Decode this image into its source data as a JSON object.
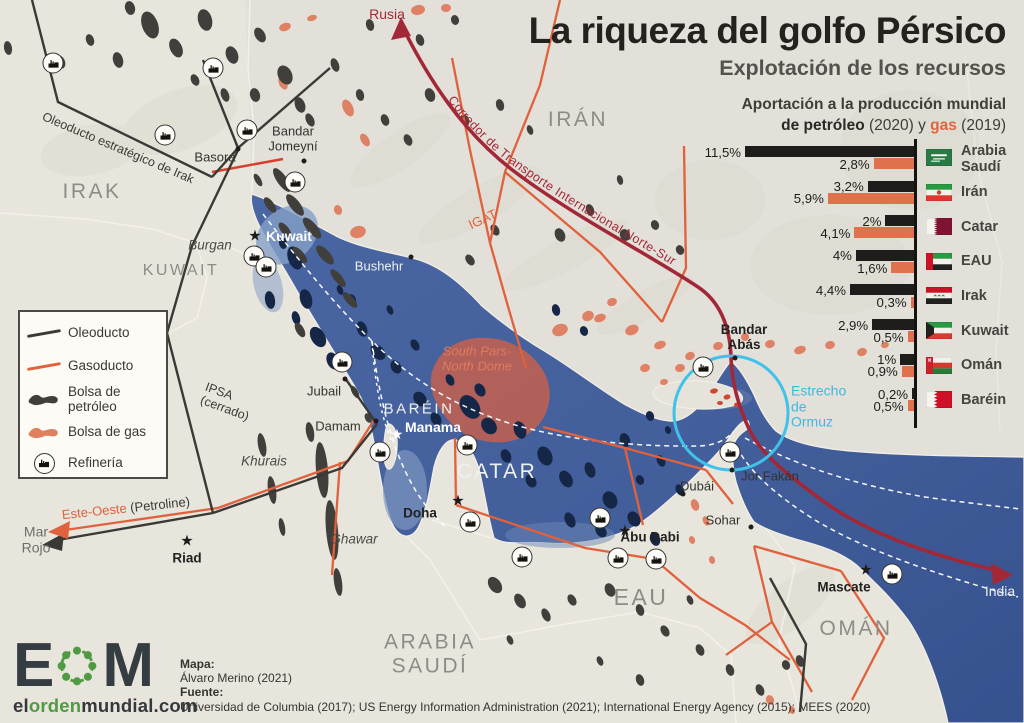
{
  "header": {
    "title": "La riqueza del golfo Pérsico",
    "subtitle": "Explotación de los recursos"
  },
  "chart": {
    "title_line1": "Aportación a la producción mundial",
    "title2_bold": "de petróleo",
    "title2_mid": " (2020) y ",
    "title2_gas": "gas",
    "title2_post": " (2019)",
    "petroleo_color": "#1e1d1b",
    "gas_color": "#e0714d"
  },
  "chart_data": {
    "type": "bar",
    "orientation": "horizontal",
    "title": "Aportación a la producción mundial de petróleo (2020) y gas (2019)",
    "unit": "%",
    "categories": [
      "Arabia Saudí",
      "Irán",
      "Catar",
      "EAU",
      "Irak",
      "Kuwait",
      "Omán",
      "Baréin"
    ],
    "display_names": [
      [
        "Arabia",
        "Saudí"
      ],
      [
        "Irán"
      ],
      [
        "Catar"
      ],
      [
        "EAU"
      ],
      [
        "Irak"
      ],
      [
        "Kuwait"
      ],
      [
        "Omán"
      ],
      [
        "Baréin"
      ]
    ],
    "flags": [
      "sa",
      "ir",
      "qa",
      "ae",
      "iq",
      "kw",
      "om",
      "bh"
    ],
    "series": [
      {
        "name": "petróleo (2020)",
        "color": "#1e1d1b",
        "values": [
          11.5,
          3.2,
          2,
          4,
          4.4,
          2.9,
          1,
          0.2
        ],
        "labels": [
          "11,5%",
          "3,2%",
          "2%",
          "4%",
          "4,4%",
          "2,9%",
          "1%",
          "0,2%"
        ]
      },
      {
        "name": "gas (2019)",
        "color": "#e0714d",
        "values": [
          2.8,
          5.9,
          4.1,
          1.6,
          0.3,
          0.5,
          0.9,
          0.5
        ],
        "labels": [
          "2,8%",
          "5,9%",
          "4,1%",
          "1,6%",
          "0,3%",
          "0,5%",
          "0,9%",
          "0,5%"
        ]
      }
    ],
    "legend_position": "right-flags"
  },
  "legend": {
    "items": [
      {
        "icon": "oil-line",
        "lines": [
          "Oleoducto"
        ]
      },
      {
        "icon": "gas-line",
        "lines": [
          "Gasoducto"
        ]
      },
      {
        "icon": "oil-blob",
        "lines": [
          "Bolsa de",
          "petróleo"
        ]
      },
      {
        "icon": "gas-blob",
        "lines": [
          "Bolsa de gas"
        ]
      },
      {
        "icon": "refinery",
        "lines": [
          "Refinería"
        ]
      }
    ]
  },
  "map": {
    "country_labels": [
      {
        "text": "IRAK",
        "x": 92,
        "y": 192,
        "size": 21
      },
      {
        "text": "KUWAIT",
        "x": 181,
        "y": 271,
        "size": 16
      },
      {
        "text": "IRÁN",
        "x": 578,
        "y": 120,
        "size": 21
      },
      {
        "text": "BARÉIN",
        "x": 419,
        "y": 410,
        "size": 15,
        "white": true
      },
      {
        "text": "CATAR",
        "x": 497,
        "y": 472,
        "size": 21,
        "white": true
      },
      {
        "text": "EAU",
        "x": 641,
        "y": 598,
        "size": 23
      },
      {
        "lines": [
          "ARABIA",
          "SAUDÍ"
        ],
        "x": 430,
        "y": 654,
        "size": 21
      },
      {
        "text": "OMÁN",
        "x": 856,
        "y": 629,
        "size": 21
      }
    ],
    "city_labels": [
      {
        "text": "Basora",
        "x": 215,
        "y": 158,
        "cls": "city"
      },
      {
        "lines": [
          "Bandar",
          "Jomeyní"
        ],
        "x": 293,
        "y": 139,
        "cls": "city"
      },
      {
        "text": "Kuwait",
        "x": 289,
        "y": 237,
        "cls": "city-white-bold"
      },
      {
        "text": "Bushehr",
        "x": 379,
        "y": 267,
        "cls": "city-white"
      },
      {
        "text": "Jubail",
        "x": 324,
        "y": 392,
        "cls": "city"
      },
      {
        "text": "Damam",
        "x": 338,
        "y": 427,
        "cls": "city"
      },
      {
        "text": "Manama",
        "x": 433,
        "y": 428,
        "cls": "city-white-bold"
      },
      {
        "text": "Doha",
        "x": 420,
        "y": 513,
        "cls": "city-bold"
      },
      {
        "text": "Riad",
        "x": 187,
        "y": 558,
        "cls": "city-bold"
      },
      {
        "text": "Abu Dabi",
        "x": 650,
        "y": 537,
        "cls": "city-bold"
      },
      {
        "text": "Dubái",
        "x": 697,
        "y": 487,
        "cls": "city"
      },
      {
        "text": "Jor Fakán",
        "x": 770,
        "y": 477,
        "cls": "city"
      },
      {
        "text": "Sohar",
        "x": 723,
        "y": 521,
        "cls": "city"
      },
      {
        "text": "Mascate",
        "x": 844,
        "y": 587,
        "cls": "city-bold"
      },
      {
        "lines": [
          "Bandar",
          "Abás"
        ],
        "x": 744,
        "y": 337,
        "cls": "city-bold"
      }
    ],
    "field_labels": [
      {
        "text": "Burgan",
        "x": 210,
        "y": 245
      },
      {
        "text": "Khurais",
        "x": 264,
        "y": 461
      },
      {
        "text": "Ghawar",
        "x": 354,
        "y": 539
      }
    ],
    "stacked_labels": [
      {
        "lines": [
          "South Pars-",
          "North Dome"
        ],
        "x": 477,
        "y": 359,
        "color": "#e07a5d",
        "size": 13,
        "italic": true
      },
      {
        "lines": [
          "Estrecho",
          "de",
          "Ormuz"
        ],
        "x": 791,
        "y": 407,
        "color": "#3cb9e2",
        "size": 14,
        "align": "left"
      },
      {
        "lines": [
          "Mar",
          "Rojo"
        ],
        "x": 36,
        "y": 540,
        "color": "#6f6e68",
        "size": 14
      }
    ],
    "rotated_labels": [
      {
        "parts": [
          {
            "t": "Oleoducto estratégico de Irak",
            "c": "#3b3a35"
          }
        ],
        "x": 118,
        "y": 148,
        "rot": 23,
        "size": 12.5
      },
      {
        "parts": [
          {
            "t": "IGAT",
            "c": "#e0613c"
          }
        ],
        "x": 483,
        "y": 220,
        "rot": -25,
        "size": 13
      },
      {
        "parts": [
          {
            "t": "IPSA\n(cerrado)",
            "c": "#3b3a35"
          }
        ],
        "x": 227,
        "y": 402,
        "rot": 20,
        "size": 12.5
      },
      {
        "parts": [
          {
            "t": "Este-Oeste",
            "c": "#e0613c"
          },
          {
            "t": " (Petroline)",
            "c": "#3b3a35"
          }
        ],
        "x": 126,
        "y": 509,
        "rot": -6,
        "size": 13
      }
    ],
    "corridor_label": "Corredor de Transporte Internacional Norte-Sur",
    "flow_labels": [
      {
        "text": "Rusia",
        "x": 387,
        "y": 15,
        "color": "#a32837",
        "size": 14
      },
      {
        "text": "India",
        "x": 1000,
        "y": 592,
        "color": "#e8ecf2",
        "size": 14
      }
    ],
    "stars": [
      {
        "x": 255,
        "y": 236,
        "white": false,
        "name": "kuwait-capital-star"
      },
      {
        "x": 397,
        "y": 434,
        "white": true,
        "name": "manama-capital-star"
      },
      {
        "x": 458,
        "y": 501,
        "white": false,
        "name": "doha-capital-star"
      },
      {
        "x": 187,
        "y": 541,
        "white": false,
        "name": "riad-capital-star"
      },
      {
        "x": 625,
        "y": 531,
        "white": false,
        "name": "abu-dabi-capital-star"
      },
      {
        "x": 866,
        "y": 570,
        "white": false,
        "name": "mascate-capital-star"
      }
    ],
    "dots": [
      [
        238,
        149
      ],
      [
        304,
        161
      ],
      [
        411,
        257
      ],
      [
        345,
        379
      ],
      [
        376,
        421
      ],
      [
        683,
        494
      ],
      [
        732,
        470
      ],
      [
        751,
        527
      ],
      [
        735,
        358
      ]
    ],
    "refineries": [
      [
        53,
        63
      ],
      [
        213,
        68
      ],
      [
        165,
        135
      ],
      [
        247,
        130
      ],
      [
        295,
        182
      ],
      [
        254,
        256
      ],
      [
        266,
        267
      ],
      [
        342,
        362
      ],
      [
        380,
        452
      ],
      [
        467,
        445
      ],
      [
        470,
        522
      ],
      [
        522,
        557
      ],
      [
        600,
        518
      ],
      [
        618,
        558
      ],
      [
        656,
        559
      ],
      [
        703,
        367
      ],
      [
        730,
        452
      ],
      [
        892,
        574
      ]
    ]
  },
  "footer": {
    "logo": {
      "e": "E",
      "m": "M",
      "d1": "el",
      "d2": "orden",
      "d3": "mundial.com"
    },
    "credits": {
      "map_label": "Mapa:",
      "map_author": "Álvaro Merino (2021)",
      "source_label": "Fuente:",
      "source_text": "Universidad de Columbia (2017); US Energy Information Administration (2021); International Energy Agency (2015); MEES (2020)"
    }
  }
}
